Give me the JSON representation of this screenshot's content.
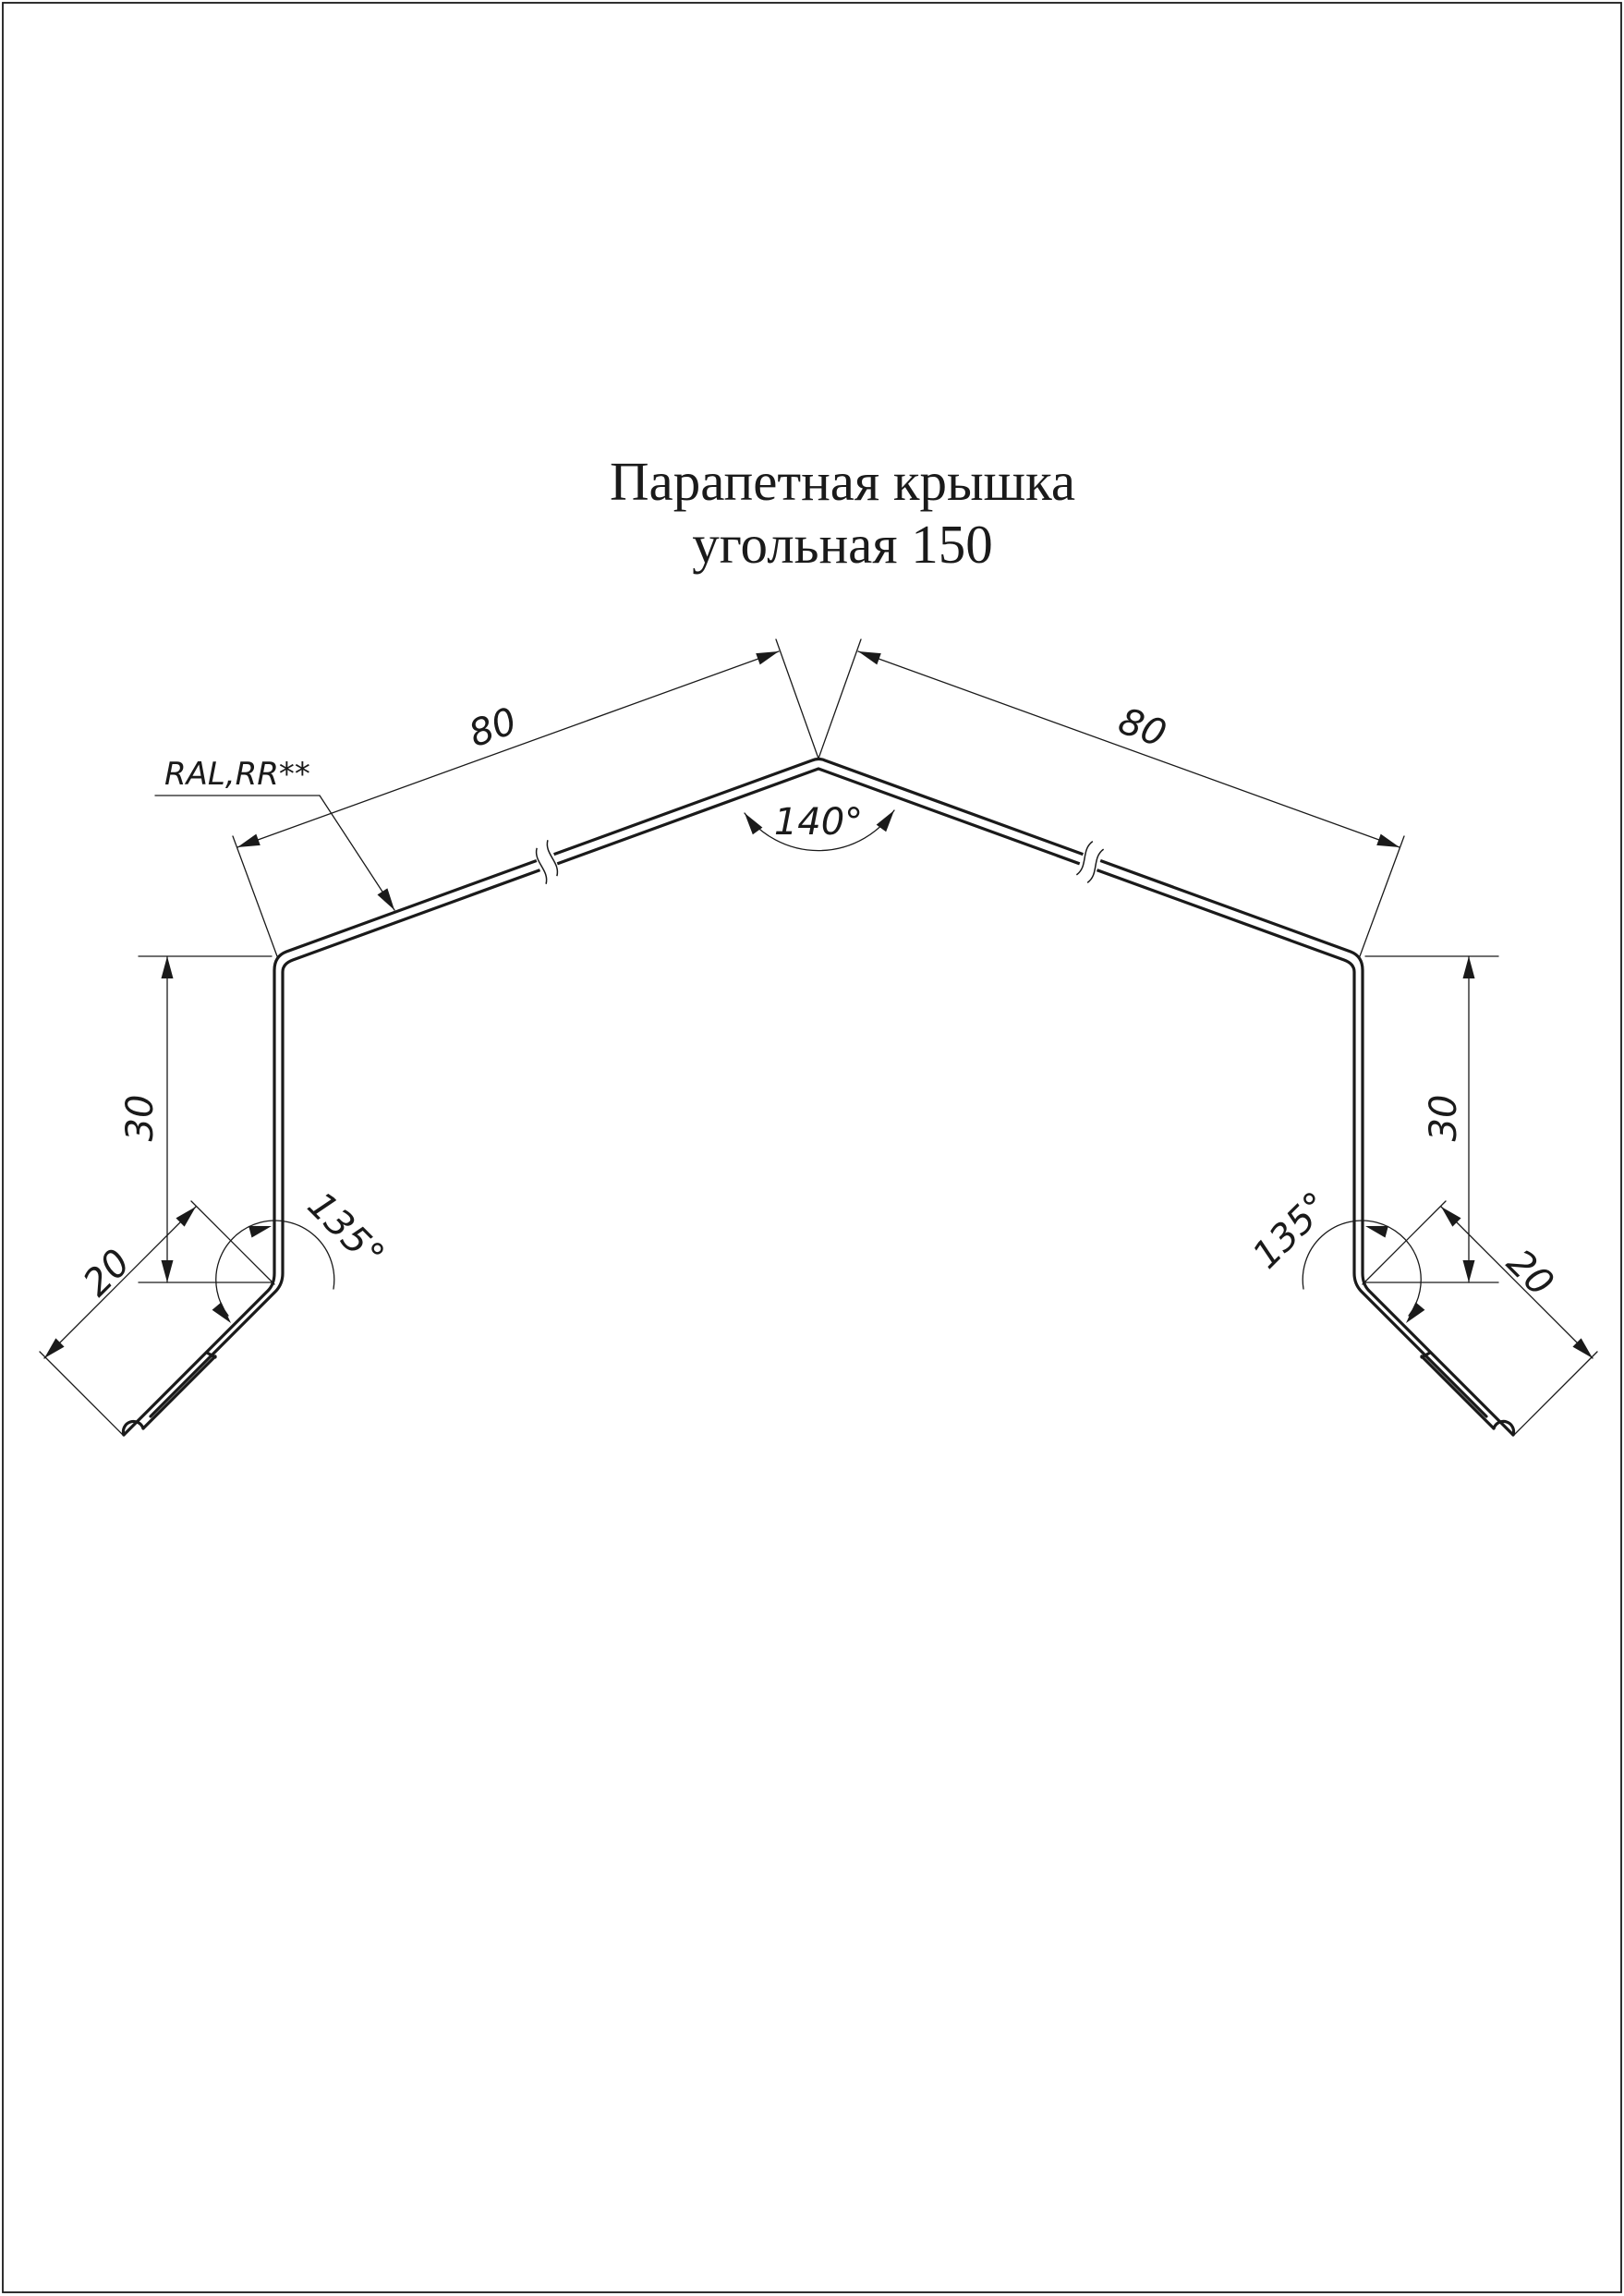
{
  "page": {
    "background": "#ffffff",
    "line_color": "#1a1a1a",
    "border_color": "#1a1a1a"
  },
  "title": {
    "line1": "Парапетная крышка",
    "line2": "угольная 150"
  },
  "callout": {
    "material_note": "RAL,RR**"
  },
  "dimensions": {
    "slope_left": "80",
    "slope_right": "80",
    "apex_angle": "140°",
    "leg_left": "30",
    "leg_right": "30",
    "flange_left": "20",
    "flange_right": "20",
    "bend_angle_left": "135°",
    "bend_angle_right": "135°"
  },
  "drawing_spec": {
    "type": "sheet-metal parapet cap profile, 2D section",
    "product_name": "Парапетная крышка угольная 150",
    "slope_lengths_mm": [
      80,
      80
    ],
    "apex_angle_deg": 140,
    "side_drop_mm": 30,
    "kick_flange_mm": 20,
    "kick_angle_deg": 135,
    "coating_note": "RAL,RR**",
    "features": [
      "double-line sheet thickness",
      "hemmed flange tips",
      "break marks on both slopes"
    ]
  }
}
